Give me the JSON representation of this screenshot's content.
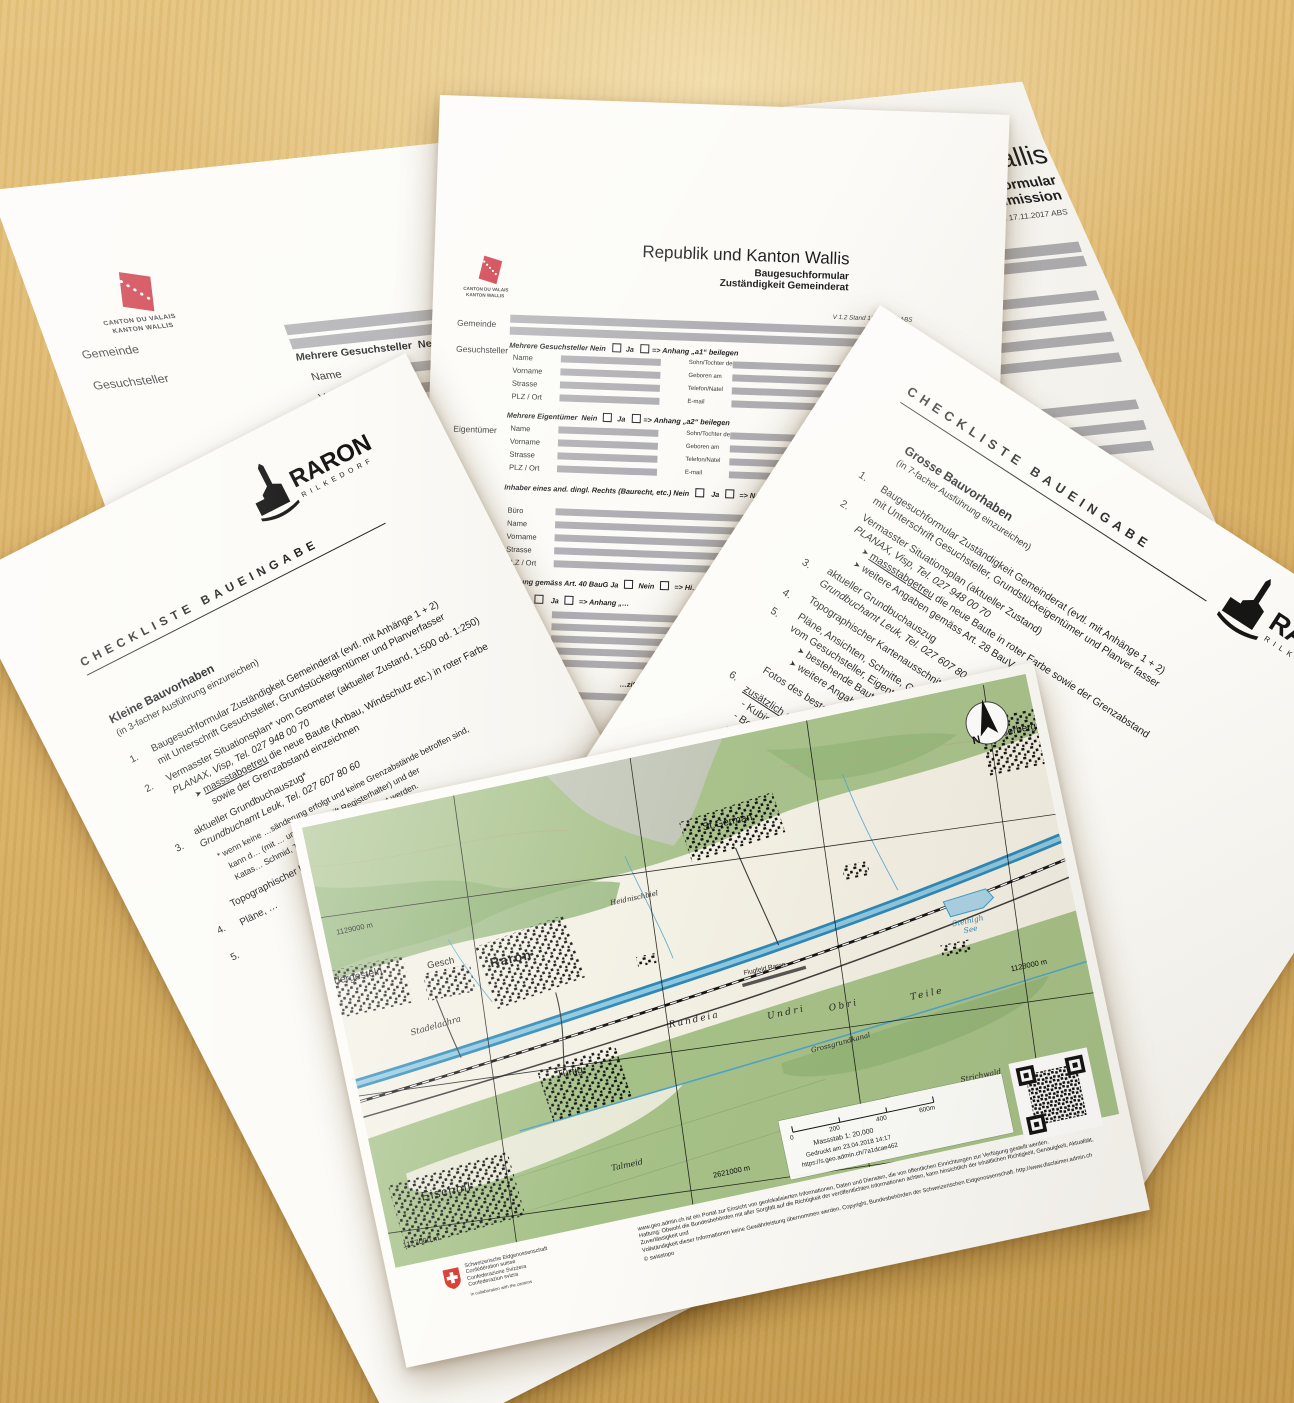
{
  "colors": {
    "wood": "#d9af63",
    "paper": "#fcfbf7",
    "field_gray": "#aeaeb2",
    "canton_red": "#c8202e",
    "swiss_red": "#d52b1e",
    "map_green": "#a6c188",
    "map_blue": "#3f9cc7",
    "ink": "#1d1d1f"
  },
  "common": {
    "nein": "Nein",
    "ja": "Ja",
    "bullet": "➤"
  },
  "form_a": {
    "title": "Republik und Kanton Wallis",
    "subtitle1": "Baugesuchformular",
    "subtitle2": "Zuständigkeit Kantonale Baukommission",
    "version": "V 1.2 Stand 17.11.2017 ABS",
    "logo1": "CANTON DU VALAIS",
    "logo2": "KANTON WALLIS",
    "gemeinde": "Gemeinde",
    "gesuchsteller": "Gesuchsteller",
    "eigentuemer": "Eigentümer",
    "mehrere_g": "Mehrere Gesuchsteller",
    "mehrere_e": "Mehrere Eigentümer",
    "anhang1": "=> Anhang „a1“ beilegen",
    "anhang2": "=> Anhang „a2“ beilegen",
    "f1": "Name",
    "f2": "Vorname",
    "f3": "Strasse",
    "f4": "PLZ / Ort",
    "r1": "Sohn/Tochter des",
    "r2": "Geboren am",
    "r3": "Telefon/Natel",
    "r4": "E-mail",
    "inhaber": "Inhaber eines and. dingl. Rechts (Baurecht, etc.) Nein"
  },
  "form_b": {
    "title": "Republik und Kanton Wallis",
    "subtitle1": "Baugesuchformular",
    "subtitle2": "Zuständigkeit Gemeinderat",
    "version": "V 1.2 Stand 17.11.2017 ABS",
    "logo1": "CANTON DU VALAIS",
    "logo2": "KANTON WALLIS",
    "gemeinde": "Gemeinde",
    "gesuchsteller": "Gesuchsteller",
    "eigentuemer": "Eigentümer",
    "buero": "Büro",
    "mehrere_g": "Mehrere Gesuchsteller",
    "mehrere_e": "Mehrere Eigentümer",
    "anhang1": "=> Anhang „a1“ beilegen",
    "anhang2": "=> Anhang „a2“ beilegen",
    "f1": "Name",
    "f2": "Vorname",
    "f3": "Strasse",
    "f4": "PLZ / Ort",
    "r1": "Sohn/Tochter des",
    "r2": "Geboren am",
    "r3": "Telefon/Natel",
    "r4": "E-mail",
    "inhaber": "Inhaber eines and. dingl. Rechts (Baurecht, etc.) Nein",
    "nachweis": "=> Nachweis…",
    "katas": "Katas…",
    "row40a": "…gung gemäss Art. 40 BauG",
    "row40b": "=> Hi…",
    "rowxa": "…eden",
    "rowxb": "=> Anhang „…",
    "rowz": "…ziffer ist …"
  },
  "check_small": {
    "title": "CHECKLISTE BAUEINGABE",
    "heading": "Kleine Bauvorhaben",
    "sub": "(in 3-facher Ausführung einzureichen)",
    "i1n": "1.",
    "i1a": "Baugesuchformular Zuständigkeit Gemeinderat (evtl. mit Anhänge 1 + 2)",
    "i1b": "mit Unterschrift Gesuchsteller, Grundstückeigentümer und Planverfasser",
    "i2n": "2.",
    "i2a": "Vermasster Situationsplan* vom Geometer (aktueller Zustand, 1:500 od. 1:250)",
    "i2b": "PLANAX, Visp, Tel. 027 948 00 70",
    "i2c": "massstabgetreu",
    "i2d": " die neue Baute (Anbau, Windschutz etc.) in roter Farbe",
    "i2e": "sowie der Grenzabstand einzeichnen",
    "i3n": "3.",
    "i3a": "aktueller Grundbuchauszug*",
    "i3b": "Grundbuchamt Leuk, Tel. 027 607 80 60",
    "n1": "* wenn keine …sänderung erfolgt und keine Grenzabstände betroffen sind,",
    "n2": "kann d… (mit … und Unterschrift Registerhalter) und der",
    "n3": "Katas… Schmid, Tel. 027 935 86 68 beigelegt werden.",
    "i4n": "4.",
    "i4a": "Topographischer Kartenausschnitt…",
    "i5n": "5.",
    "i5a": "Pläne, …"
  },
  "check_big": {
    "title": "CHECKLISTE BAUEINGABE",
    "heading": "Grosse Bauvorhaben",
    "sub": "(in 7-facher Ausführung einzureichen)",
    "i1n": "1.",
    "i1a": "Baugesuchformular Zuständigkeit Gemeinderat (evtl. mit Anhänge 1 + 2)",
    "i1b": "mit Unterschrift Gesuchsteller, Grundstückeigentümer und Planver fasser",
    "i2n": "2.",
    "i2a": "Vermasster Situationsplan (aktueller Zustand)",
    "i2b": "PLANAX, Visp, Tel. 027 948 00 70",
    "i2c": "massstabgetreu",
    "i2d": " die neue Baute in roter Farbe sowie der Grenzabstand",
    "i2e": "weitere Angaben gemäss Art. 28 BauV",
    "i3n": "3.",
    "i3a": "aktueller Grundbuchauszug",
    "i3b": "Grundbuchamt Leuk, Tel. 027 607 80 60",
    "i4n": "4.",
    "i4a": "Topographischer Kartenausschnitt",
    "i5n": "5.",
    "i5a": "Pläne, Ansichten, Schnitte, Grundrisse…",
    "i5b": "vom Gesuchsteller, Eigentümer und…",
    "i5c": "bestehende Bauten schwarz…",
    "i5d": "weitere Angaben gemäss…",
    "i6n": "6.",
    "i6a": "Fotos des bestehenden…",
    "zt": "zusätzlich erforderlich…",
    "z1": "- Kubische Ber…",
    "z2": "- Berechnu…",
    "z3": "- Nachw…",
    "z4": "- Ene…"
  },
  "raron": {
    "name": "RARON",
    "sub": "RILKEDORF"
  },
  "map": {
    "north": "N",
    "places": {
      "raron": "Raron",
      "stgerman": "St.German",
      "turtig": "Turtig",
      "gesch": "Gesch",
      "niedergesteln": "Niedergesteln",
      "eischoll": "Eischoll",
      "ausserberg": "Ausserberg",
      "see1": "Steinigh",
      "see2": "See",
      "rundeia": "Rundeia",
      "undri": "Undri",
      "obri": "Obri",
      "teile": "Teile",
      "kanal": "Grossgrundkanal",
      "flugfeld": "Flugfeld Raron",
      "stadelachra": "Stadelachra",
      "heidnischbiel": "Heidnischbiel",
      "strichwald": "Strichwald",
      "talmeid": "Talmeid"
    },
    "grid": {
      "n1": "1129000 m",
      "n2": "1128000 m",
      "n3": "1127000 m",
      "e1": "2621000 m"
    },
    "scale": {
      "t0": "0",
      "t1": "200",
      "t2": "400",
      "t3": "600m",
      "massstab": "Massstab 1: 20,000",
      "printed": "Gedruckt am 23.04.2018 14:17",
      "url": "https://s.geo.admin.ch/7a1dcae462"
    },
    "footer": {
      "l1": "www.geo.admin.ch ist ein Portal zur Einsicht von geolokalisierten Informationen, Daten und Diensten, die von öffentlichen Einrichtungen zur Verfügung gestellt werden.",
      "l2": "Haftung: Obwohl die Bundesbehörden mit aller Sorgfalt auf die Richtigkeit der veröffentlichten Informationen achten, kann hinsichtlich der inhaltlichen Richtigkeit, Genauigkeit, Aktualität, Zuverlässigkeit und",
      "l3": "Vollständigkeit dieser Informationen keine Gewährleistung übernommen werden. Copyright, Bundesbehörden der Schweizerischen Eidgenossenschaft. http://www.disclaimer.admin.ch",
      "copyright": "© swisstopo"
    },
    "swiss": {
      "l1": "Schweizerische Eidgenossenschaft",
      "l2": "Confédération suisse",
      "l3": "Confederazione Svizzera",
      "l4": "Confederaziun svizra",
      "note": "In collaboration with the cantons"
    }
  }
}
